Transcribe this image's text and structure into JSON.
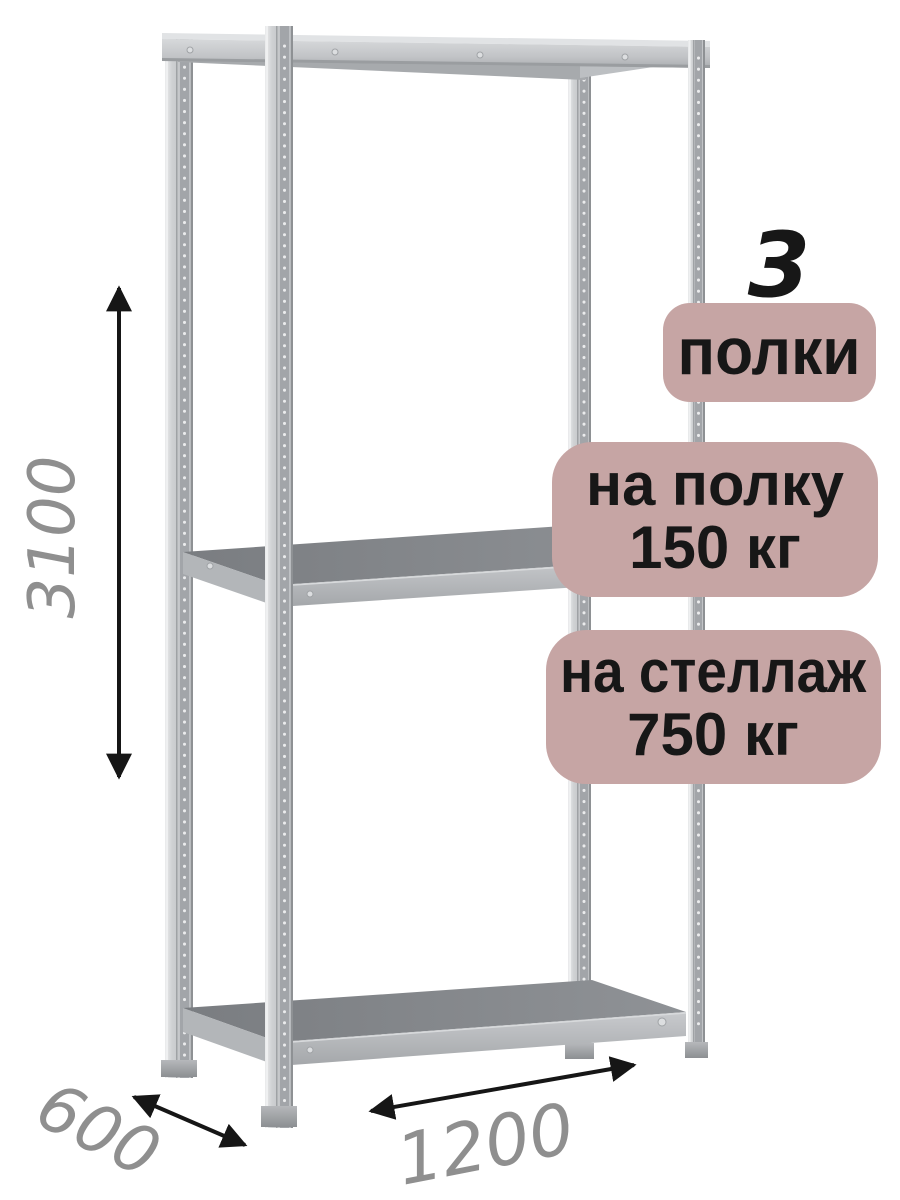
{
  "dimensions": {
    "height": "3100",
    "depth": "600",
    "width": "1200"
  },
  "badges": {
    "shelf_count": {
      "value": "3",
      "label": "полки"
    },
    "shelf_load": {
      "line1": "на полку",
      "line2": "150 кг"
    },
    "rack_load": {
      "line1": "на стеллаж",
      "line2": "750 кг"
    }
  },
  "colors": {
    "background": "#ffffff",
    "badge_bg": "#c6a5a4",
    "badge_text": "#171717",
    "dimension_text": "#8f8f8f",
    "arrow": "#161616",
    "metal_light": "#d8dadc",
    "metal_mid": "#c1c3c6",
    "metal_dark": "#85888c"
  }
}
